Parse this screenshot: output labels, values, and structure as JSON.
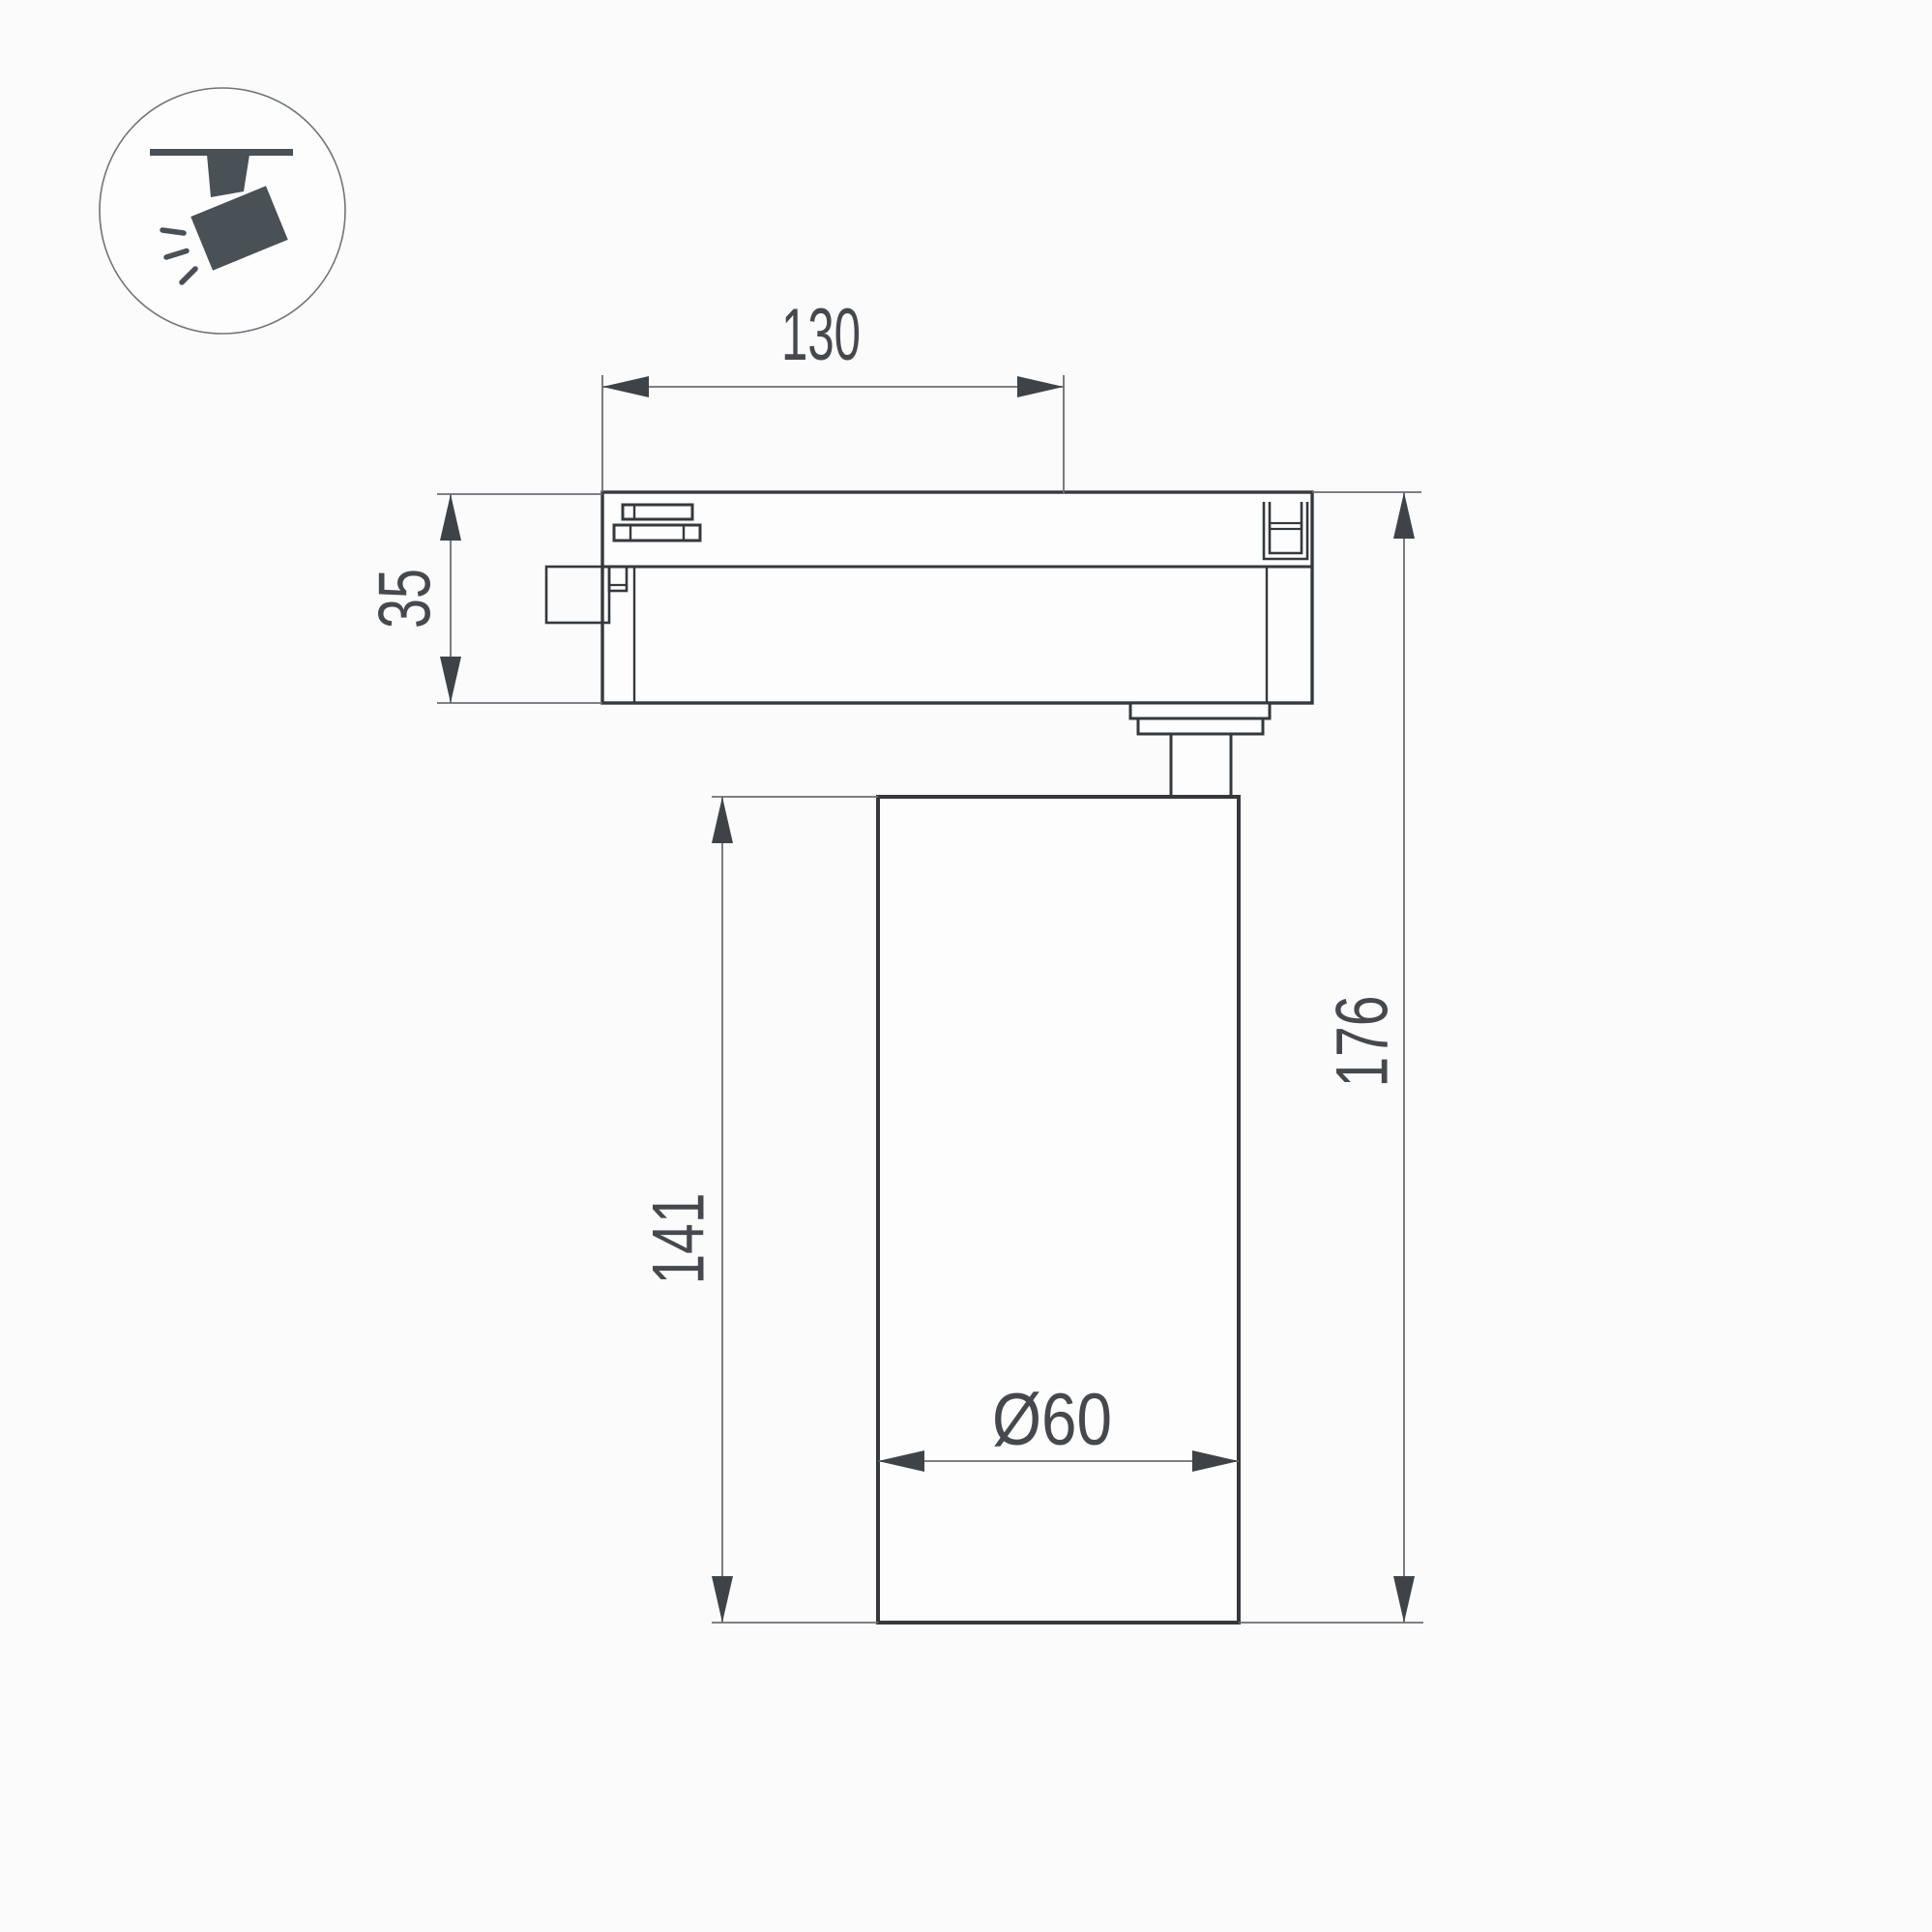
{
  "page": {
    "background": "#fbfbfb",
    "kind": "technical dimension drawing",
    "subject": "LED track spotlight, side elevation with dimensions (mm)"
  },
  "icon_badge": {
    "name": "ceiling-track-spotlight",
    "description": "circular badge with dark spotlight hanging from a track, emitting light rays"
  },
  "dimensions": {
    "track_width": "130",
    "adapter_height": "35",
    "body_height": "141",
    "overall_height": "176",
    "diameter": "Ø60"
  },
  "colors": {
    "object_line": "#35393d",
    "dimension_line": "#6b6f73",
    "arrow": "#3e4348",
    "text": "#45494d",
    "icon_fill": "#495056",
    "icon_circle_stroke": "#707478",
    "shape_fill": "#fdfdfd"
  }
}
